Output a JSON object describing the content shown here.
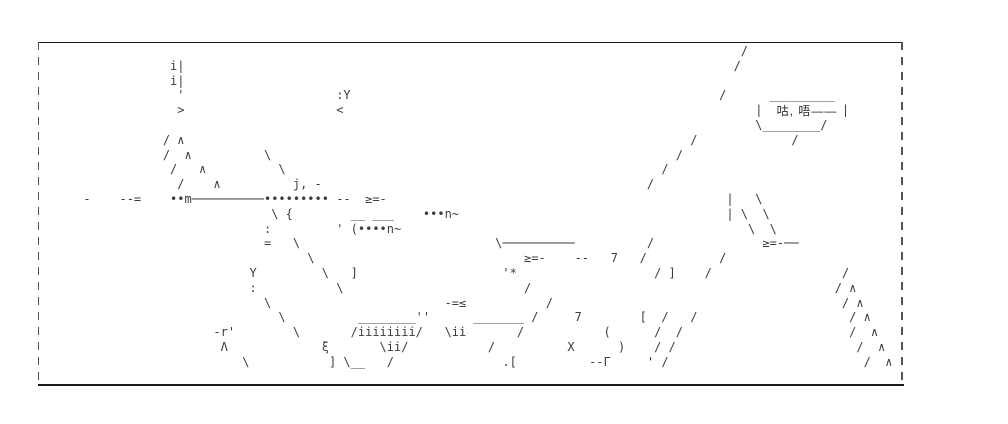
{
  "speech_bubble": {
    "text": "咕, 唔——"
  },
  "colors": {
    "ink": "#3d3d3d",
    "frame": "#1a1a1a",
    "background": "#ffffff"
  },
  "ascii_art": {
    "rows": [
      [
        [
          97,
          "/"
        ]
      ],
      [
        [
          18,
          "i|"
        ],
        [
          96,
          "/"
        ]
      ],
      [
        [
          18,
          "i|"
        ]
      ],
      [
        [
          19,
          "'"
        ],
        [
          41,
          ":Y"
        ],
        [
          94,
          "/"
        ],
        [
          101,
          "_________"
        ]
      ],
      [
        [
          19,
          ">"
        ],
        [
          41,
          "<"
        ],
        [
          99,
          "|"
        ],
        [
          111,
          "|"
        ]
      ],
      [
        [
          99,
          "\\________/"
        ]
      ],
      [
        [
          17,
          "/"
        ],
        [
          19,
          "∧"
        ],
        [
          90,
          "/"
        ],
        [
          104,
          "/"
        ]
      ],
      [
        [
          17,
          "/"
        ],
        [
          20,
          "∧"
        ],
        [
          31,
          "\\"
        ],
        [
          88,
          "/"
        ]
      ],
      [
        [
          18,
          "/"
        ],
        [
          22,
          "∧"
        ],
        [
          33,
          "\\"
        ],
        [
          86,
          "/"
        ]
      ],
      [
        [
          19,
          "/"
        ],
        [
          24,
          "∧"
        ],
        [
          35,
          "j,"
        ],
        [
          38,
          "-"
        ],
        [
          84,
          "/"
        ]
      ],
      [
        [
          6,
          "-"
        ],
        [
          11,
          "--="
        ],
        [
          18,
          "••m──────────•••••••••"
        ],
        [
          41,
          "--"
        ],
        [
          45,
          "≥=-"
        ],
        [
          95,
          "|"
        ],
        [
          99,
          "\\"
        ]
      ],
      [
        [
          32,
          "\\"
        ],
        [
          34,
          "{"
        ],
        [
          43,
          "__"
        ],
        [
          46,
          "___"
        ],
        [
          53,
          "•••n~"
        ],
        [
          95,
          "|"
        ],
        [
          97,
          "\\"
        ],
        [
          100,
          "\\"
        ]
      ],
      [
        [
          31,
          ":"
        ],
        [
          41,
          "'"
        ],
        [
          43,
          "(••••n~"
        ],
        [
          98,
          "\\"
        ],
        [
          101,
          "\\"
        ]
      ],
      [
        [
          31,
          "="
        ],
        [
          35,
          "\\"
        ],
        [
          63,
          "\\──────────"
        ],
        [
          84,
          "/"
        ],
        [
          100,
          "≥=-──"
        ]
      ],
      [
        [
          37,
          "\\"
        ],
        [
          67,
          "≥=-"
        ],
        [
          74,
          "--"
        ],
        [
          79,
          "7"
        ],
        [
          83,
          "/"
        ],
        [
          94,
          "/"
        ]
      ],
      [
        [
          29,
          "Y"
        ],
        [
          39,
          "\\"
        ],
        [
          43,
          "]"
        ],
        [
          64,
          "'*"
        ],
        [
          85,
          "/"
        ],
        [
          87,
          "]"
        ],
        [
          92,
          "/"
        ],
        [
          111,
          "/"
        ]
      ],
      [
        [
          29,
          ":"
        ],
        [
          41,
          "\\"
        ],
        [
          67,
          "/"
        ],
        [
          110,
          "/"
        ],
        [
          112,
          "∧"
        ]
      ],
      [
        [
          31,
          "\\"
        ],
        [
          56,
          "-=≤"
        ],
        [
          70,
          "/"
        ],
        [
          111,
          "/"
        ],
        [
          113,
          "∧"
        ]
      ],
      [
        [
          33,
          "\\"
        ],
        [
          44,
          "________''"
        ],
        [
          60,
          "_______"
        ],
        [
          68,
          "/"
        ],
        [
          74,
          "7"
        ],
        [
          83,
          "["
        ],
        [
          86,
          "/"
        ],
        [
          90,
          "/"
        ],
        [
          112,
          "/"
        ],
        [
          114,
          "∧"
        ]
      ],
      [
        [
          24,
          "-r'"
        ],
        [
          35,
          "\\"
        ],
        [
          43,
          "/iiiiiiii/"
        ],
        [
          56,
          "\\ii"
        ],
        [
          66,
          "/"
        ],
        [
          78,
          "("
        ],
        [
          85,
          "/"
        ],
        [
          88,
          "/"
        ],
        [
          112,
          "/"
        ],
        [
          115,
          "∧"
        ]
      ],
      [
        [
          25,
          "Λ"
        ],
        [
          39,
          "ξ"
        ],
        [
          47,
          "\\ii/"
        ],
        [
          62,
          "/"
        ],
        [
          73,
          "X"
        ],
        [
          80,
          ")"
        ],
        [
          85,
          "/"
        ],
        [
          87,
          "/"
        ],
        [
          113,
          "/"
        ],
        [
          116,
          "∧"
        ]
      ],
      [
        [
          28,
          "\\"
        ],
        [
          40,
          "]"
        ],
        [
          42,
          "\\__"
        ],
        [
          48,
          "/"
        ],
        [
          64,
          ".["
        ],
        [
          76,
          "--Γ"
        ],
        [
          84,
          "'"
        ],
        [
          86,
          "/"
        ],
        [
          114,
          "/"
        ],
        [
          117,
          "∧"
        ]
      ],
      []
    ]
  }
}
